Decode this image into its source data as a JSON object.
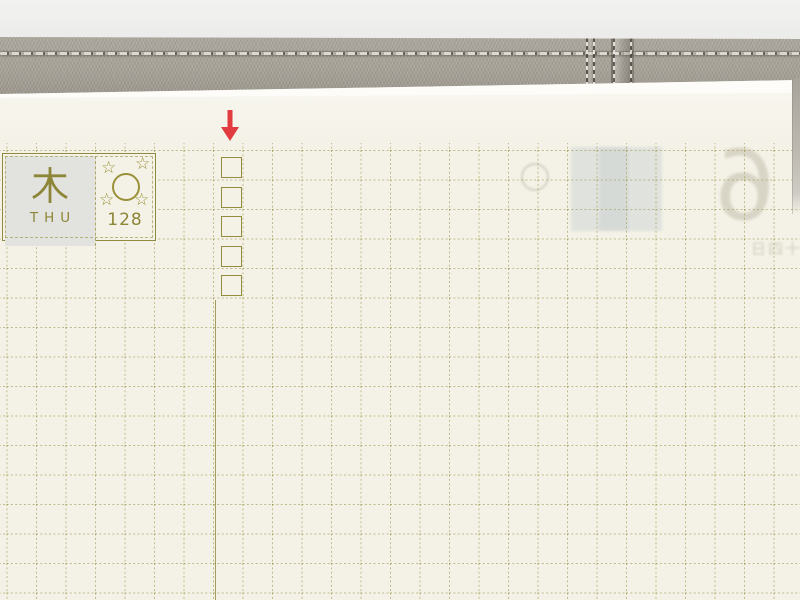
{
  "scene": {
    "backdrop": {
      "color_top": "#f2f2f1",
      "color_bottom": "#e2e2e0"
    },
    "cover": {
      "fabric_color": "#a8a399",
      "stitch_light": "#dcd8cf",
      "stitch_dark": "#6a645a"
    },
    "page_edge": {
      "color": "#fdfcf8"
    },
    "paper": {
      "color": "#f4f2e7",
      "grid_color": "#a49e58",
      "grid_cell_px": 29.5
    }
  },
  "day_header": {
    "weekday_kanji": "木",
    "weekday_abbr": "THU",
    "day_count": "128",
    "star_glyph": "☆",
    "moon_phase": "full-moon",
    "accent_color": "#8d8537",
    "highlight_color": "#e2e3df"
  },
  "checklist": {
    "checkbox_count": 5,
    "box_color": "#8d8537"
  },
  "annotation": {
    "glyph": "↓",
    "arrow_color": "#e23b40"
  },
  "show_through": {
    "large_number": "6",
    "date_text": "十四日",
    "tape_color": "#ccd3d5"
  }
}
